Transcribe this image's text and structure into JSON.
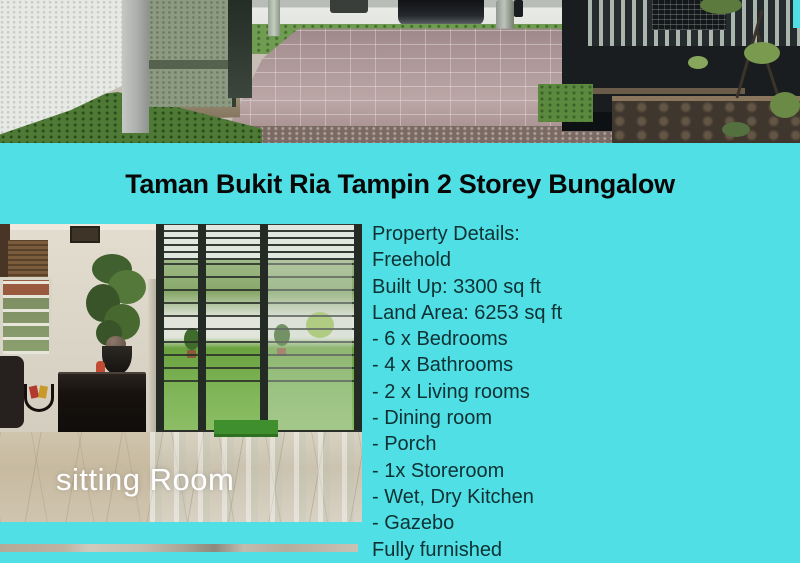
{
  "title": "Taman Bukit Ria Tampin 2 Storey Bungalow",
  "details": {
    "lines": [
      "Property Details:",
      "Freehold",
      "Built Up: 3300 sq ft",
      "Land Area: 6253 sq ft",
      "- 6 x Bedrooms",
      "- 4 x Bathrooms",
      "- 2 x Living rooms",
      "- Dining room",
      "- Porch",
      "- 1x Storeroom",
      "- Wet, Dry Kitchen",
      "- Gazebo",
      "Fully furnished"
    ]
  },
  "photos": {
    "sitting_room": {
      "caption": "sitting Room"
    }
  },
  "colors": {
    "background": "#4FDFE4",
    "title_text": "#080808",
    "details_text": "#0E3134",
    "caption_text": "#FFFFFF"
  }
}
